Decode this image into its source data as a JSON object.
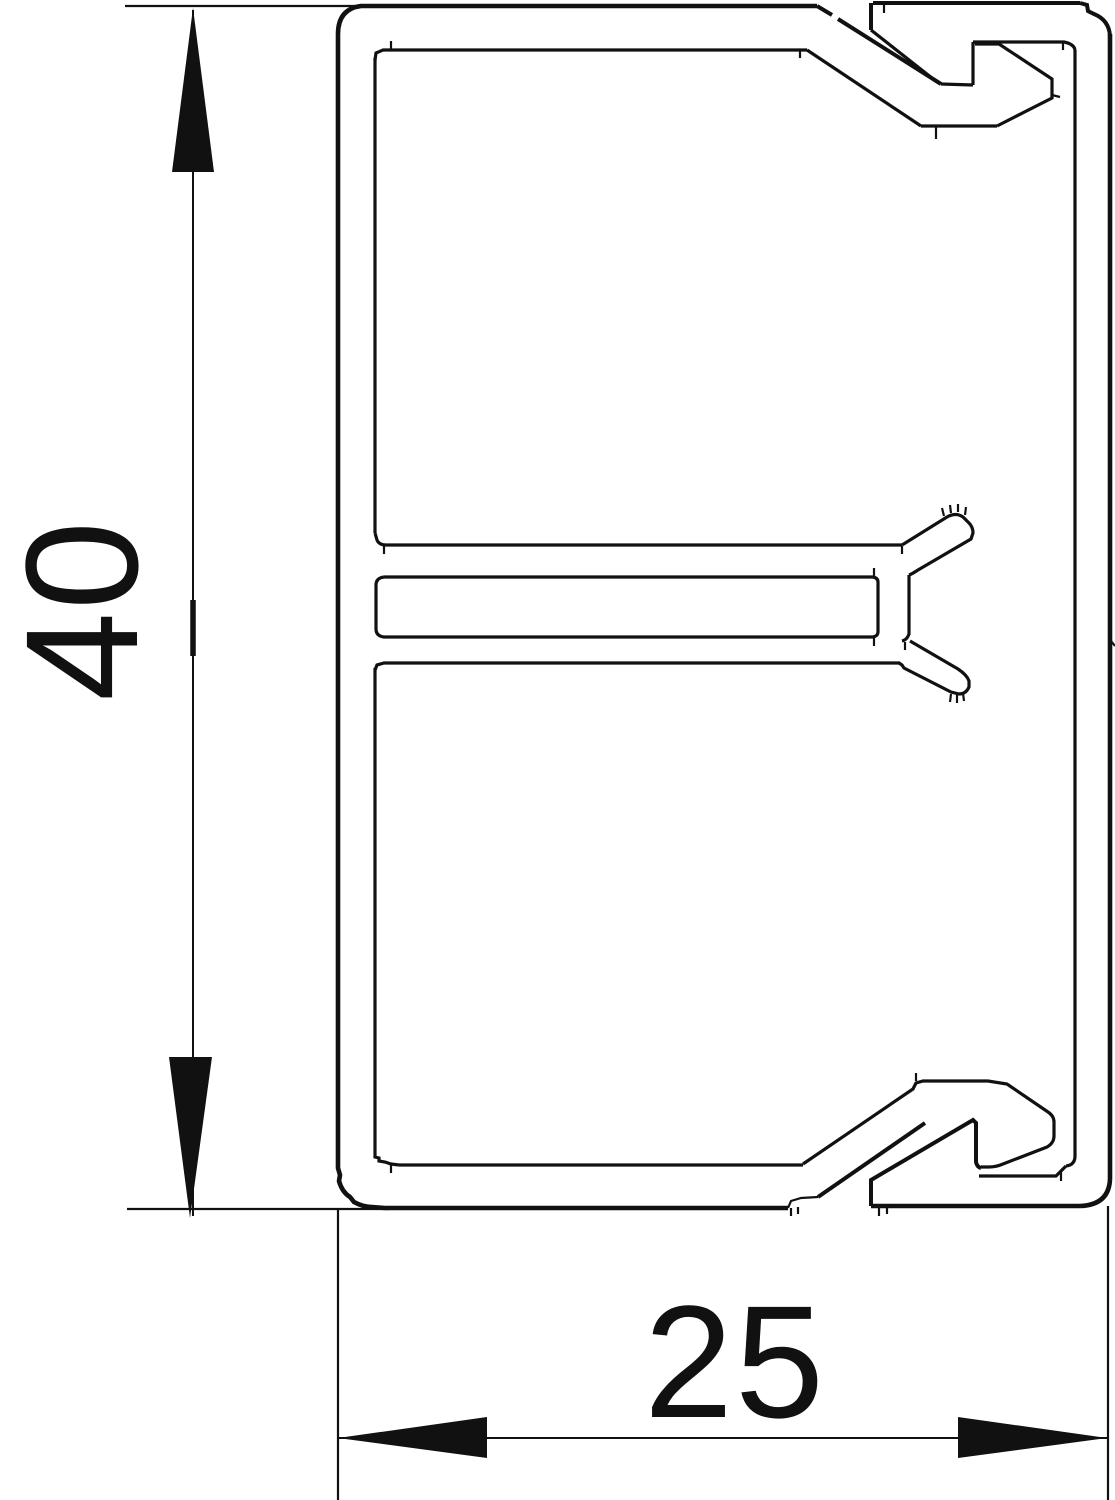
{
  "drawing": {
    "title": "Cable trunking profile cross-section",
    "type": "technical-line-drawing",
    "line_color": "#111111",
    "background_color": "#ffffff",
    "dimensions": {
      "height": {
        "label": "40",
        "orientation": "vertical"
      },
      "width": {
        "label": "25",
        "orientation": "horizontal"
      }
    },
    "parts": [
      "base-channel",
      "snap-on-cover",
      "divider-slot-bar",
      "fork-retainer-clip"
    ]
  }
}
